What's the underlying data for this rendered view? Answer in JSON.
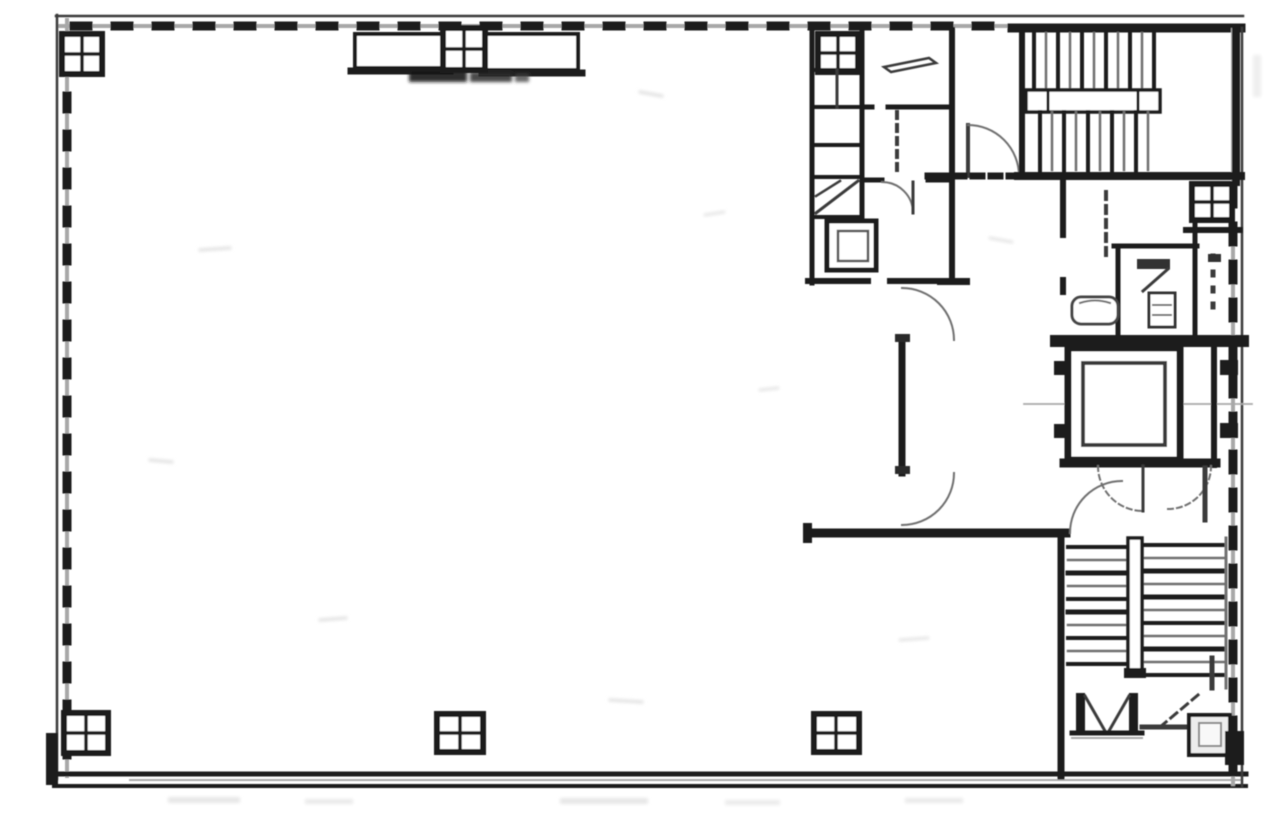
{
  "document": {
    "kind": "Scanned architectural floor plan - office building typical floor",
    "page_background": "#ffffff",
    "legible_text": "",
    "stamp_note": "illegible dark ink stamp below top-center canopy"
  },
  "palette": {
    "ink": "#1f1f1f",
    "ink_medium": "#3a3a3a",
    "ink_soft": "#6f6f6f",
    "halftone": "#a8a8a8",
    "noise": "#e0e0e0",
    "paper": "#ffffff"
  },
  "features": {
    "open_area": "large unpartitioned tenant space",
    "columns_count": 8,
    "upper_staircase": "top-right vertical treads with middle landing rail",
    "lower_staircase": "bottom-right horizontal treads with center divider",
    "elevator": "double-walled shaft with car outline and centerline",
    "restroom_block": "top-right cluster of stalls and fixtures",
    "doors": "quarter-circle swing arcs",
    "window_walls": "tick-marked curtain walls on all four edges"
  }
}
